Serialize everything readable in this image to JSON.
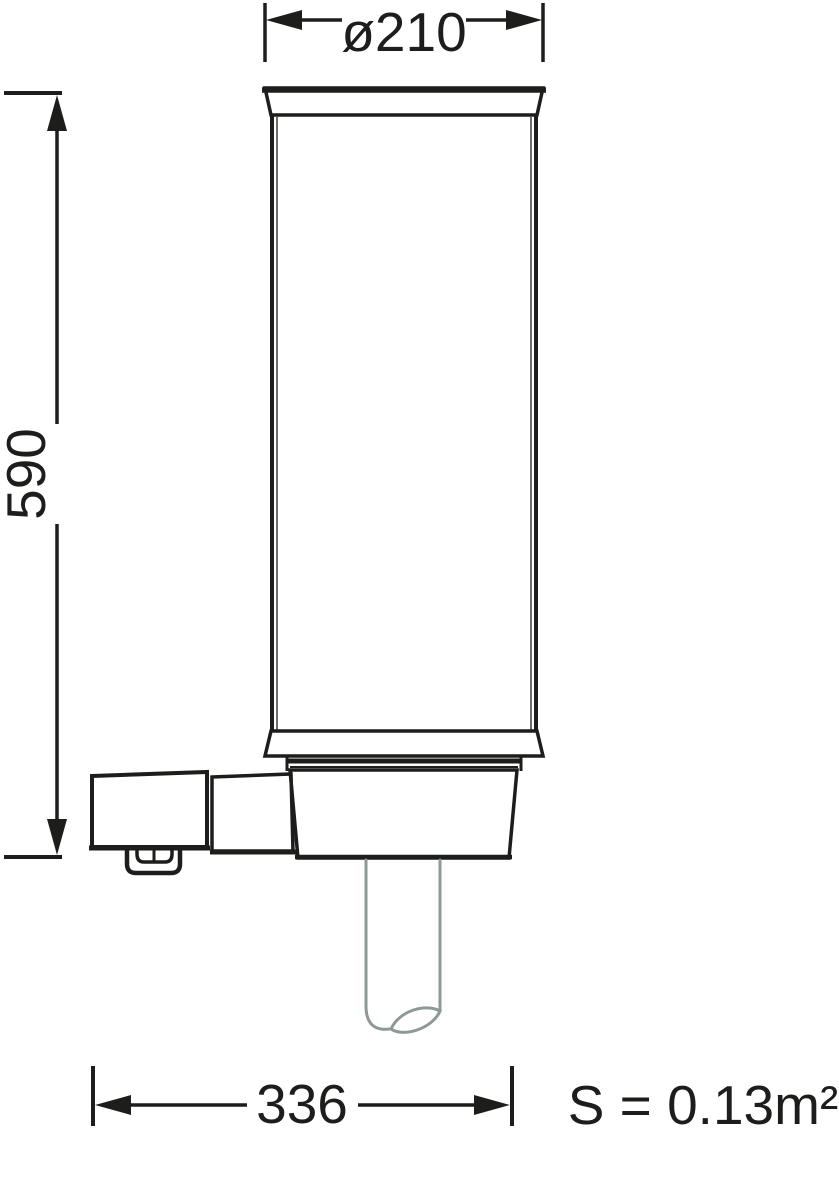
{
  "drawing": {
    "dimensions": {
      "diameter": "ø210",
      "height": "590",
      "width": "336"
    },
    "surface_area": "S = 0.13m²",
    "colors": {
      "line": "#1d1d1b",
      "pole": "#8b9a98",
      "background": "#ffffff"
    }
  }
}
